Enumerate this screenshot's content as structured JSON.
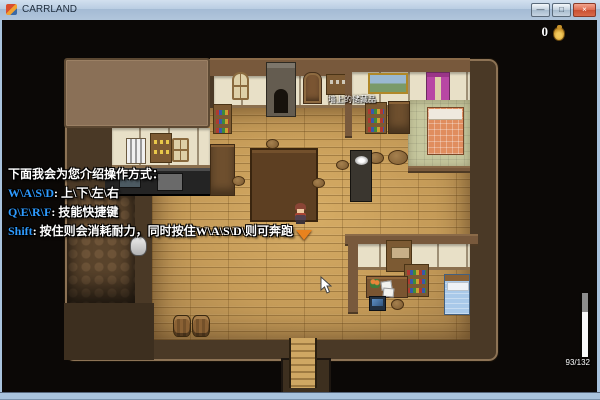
{
  "window": {
    "title": "CARRLAND",
    "minimize_glyph": "—",
    "maximize_glyph": "□",
    "close_glyph": "×"
  },
  "hud": {
    "gold_amount": "0",
    "gold_icon": "gold-pouch-icon",
    "stamina_current": 93,
    "stamina_max": 132,
    "stamina_label": "93/132",
    "stamina_fill_percent": 70
  },
  "tutorial": {
    "line1": "下面我会为您介绍操作方式：",
    "line2_key": "W\\A\\S\\D",
    "line2_text": ": 上\\下\\左\\右",
    "line3_key": "Q\\E\\R\\F",
    "line3_text": ": 技能快捷键",
    "line4_key": "Shift",
    "line4_text": ": 按住则会消耗耐力，同时按住W\\A\\S\\D\\则可奔跑"
  },
  "map": {
    "wall_label": "墙上的储藏品"
  },
  "colors": {
    "tutorial_key": "#2e9bff",
    "gold_icon": "#d9a832",
    "stamina_fill": "#f8f8f8",
    "stamina_depleted": "#8d8d8d",
    "titlebar": "#b9cde2",
    "close_button": "#c94f33"
  }
}
